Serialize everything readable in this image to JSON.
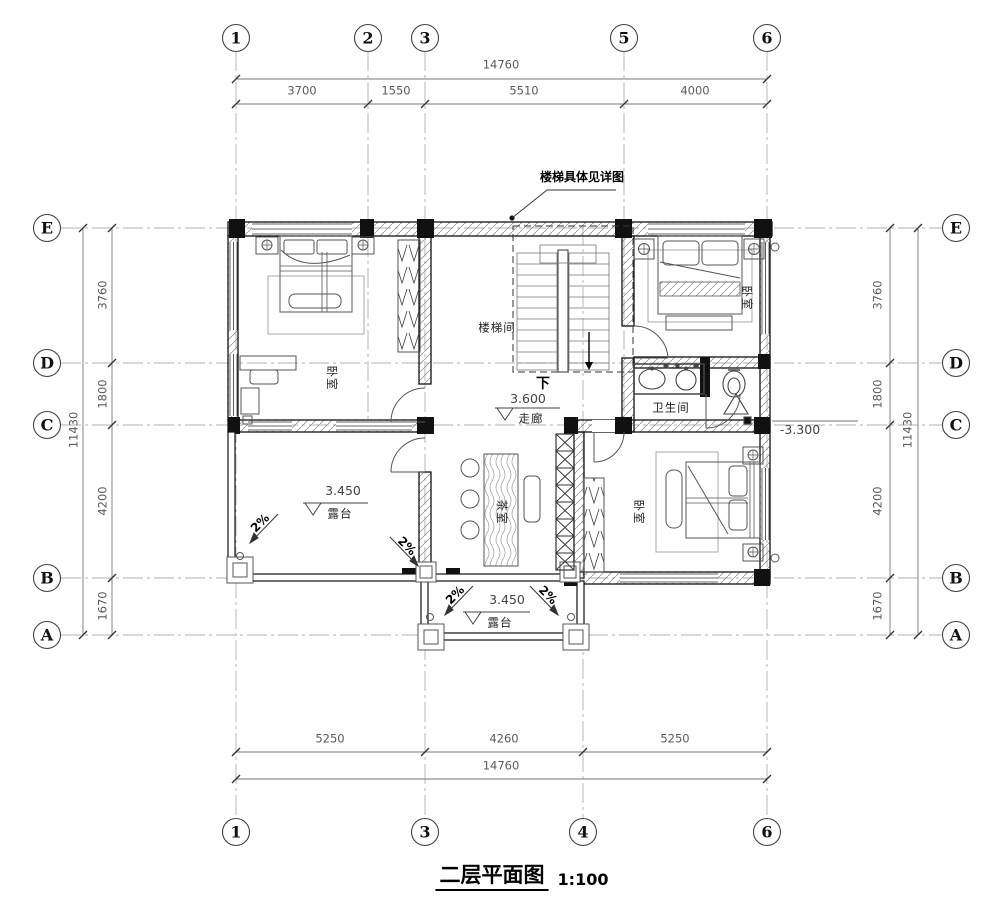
{
  "title": {
    "text": "二层平面图",
    "scale": "1:100"
  },
  "annotation": {
    "stair_note": "楼梯具体见详图",
    "down": "下",
    "slope": "2%"
  },
  "rooms": {
    "bedroom1": "卧室",
    "bedroom2": "卧室",
    "bedroom3": "卧室",
    "stairwell": "楼梯间",
    "corridor": "走廊",
    "bathroom": "卫生间",
    "tearoom": "茶室",
    "terrace_left": "露台",
    "terrace_bottom": "露台"
  },
  "elevations": {
    "corridor": "3.600",
    "terrace_left": "3.450",
    "terrace_bottom": "3.450",
    "right_side": "-3.300"
  },
  "grid": {
    "top": [
      "1",
      "2",
      "3",
      "5",
      "6"
    ],
    "bottom": [
      "1",
      "3",
      "4",
      "6"
    ],
    "left": [
      "E",
      "D",
      "C",
      "B",
      "A"
    ],
    "right": [
      "E",
      "D",
      "C",
      "B",
      "A"
    ]
  },
  "dimensions": {
    "top_total": "14760",
    "top_segments": [
      "3700",
      "1550",
      "5510",
      "4000"
    ],
    "bottom_segments": [
      "5250",
      "4260",
      "5250"
    ],
    "bottom_total": "14760",
    "left_segments": [
      "3760",
      "1800",
      "4200",
      "1670"
    ],
    "left_total": "11430",
    "right_segments": [
      "3760",
      "1800",
      "4200",
      "1670"
    ],
    "right_total": "11430"
  },
  "colors": {
    "wall": "#111111",
    "grid_line": "#b0b0b0",
    "dim_line": "#777777",
    "furniture": "#555555"
  }
}
